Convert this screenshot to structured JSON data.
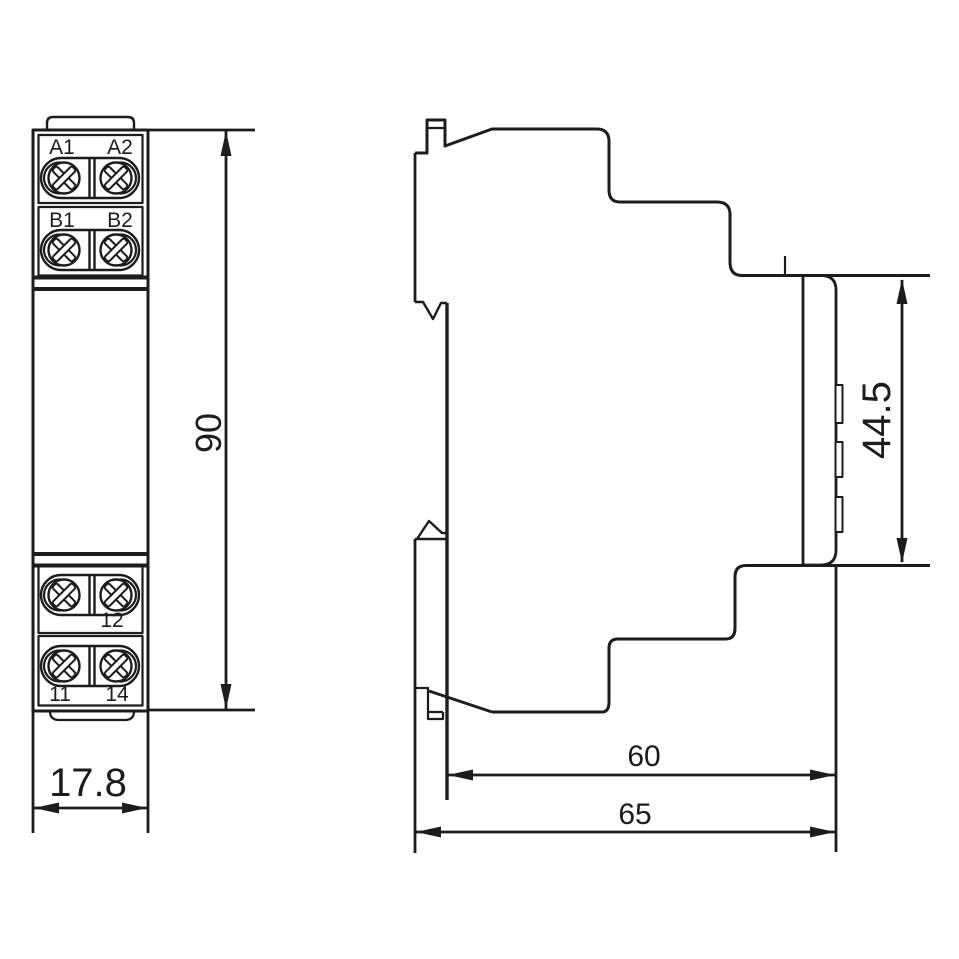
{
  "front": {
    "labels": {
      "a1": "A1",
      "a2": "A2",
      "b1": "B1",
      "b2": "B2",
      "t12": "12",
      "t11": "11",
      "t14": "14"
    },
    "dims": {
      "height": "90",
      "width": "17.8"
    }
  },
  "side": {
    "dims": {
      "front_height": "44.5",
      "depth_body": "60",
      "depth_total": "65"
    }
  },
  "colors": {
    "line": "#1c1c1c",
    "background": "#ffffff"
  }
}
